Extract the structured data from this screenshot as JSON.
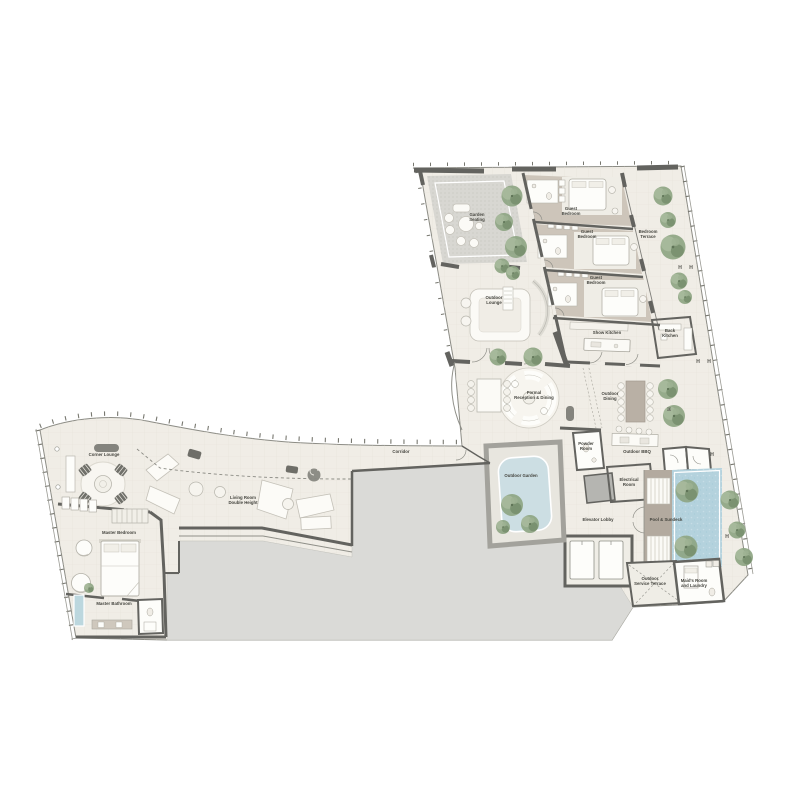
{
  "floorplan": {
    "type": "residential-floor-plan",
    "rooms": [
      {
        "id": "garden-seating",
        "label": "Garden Seating",
        "lines": [
          "Garden",
          "Seating"
        ],
        "x": 477,
        "y": 216
      },
      {
        "id": "guest-bedroom-1",
        "label": "Guest Bedroom",
        "lines": [
          "Guest",
          "Bedroom"
        ],
        "x": 571,
        "y": 210
      },
      {
        "id": "guest-bedroom-2",
        "label": "Guest Bedroom",
        "lines": [
          "Guest",
          "Bedroom"
        ],
        "x": 587,
        "y": 233
      },
      {
        "id": "guest-bedroom-3",
        "label": "Guest Bedroom",
        "lines": [
          "Guest",
          "Bedroom"
        ],
        "x": 596,
        "y": 279
      },
      {
        "id": "bedroom-terrace",
        "label": "Bedroom Terrace",
        "lines": [
          "Bedroom",
          "Terrace"
        ],
        "x": 648,
        "y": 233
      },
      {
        "id": "outdoor-lounge",
        "label": "Outdoor Lounge",
        "lines": [
          "Outdoor",
          "Lounge"
        ],
        "x": 494,
        "y": 299
      },
      {
        "id": "show-kitchen",
        "label": "Show Kitchen",
        "lines": [
          "Show Kitchen"
        ],
        "x": 607,
        "y": 334
      },
      {
        "id": "back-kitchen",
        "label": "Back Kitchen",
        "lines": [
          "Back",
          "Kitchen"
        ],
        "x": 670,
        "y": 332
      },
      {
        "id": "formal-reception-dining",
        "label": "Formal Reception & Dining",
        "lines": [
          "Formal",
          "Reception & Dining"
        ],
        "x": 534,
        "y": 394
      },
      {
        "id": "outdoor-dining",
        "label": "Outdoor Dining",
        "lines": [
          "Outdoor",
          "Dining"
        ],
        "x": 610,
        "y": 395
      },
      {
        "id": "powder-room",
        "label": "Powder Room",
        "lines": [
          "Powder",
          "Room"
        ],
        "x": 586,
        "y": 445
      },
      {
        "id": "outdoor-bbq",
        "label": "Outdoor BBQ",
        "lines": [
          "Outdoor BBQ"
        ],
        "x": 637,
        "y": 453
      },
      {
        "id": "outdoor-garden",
        "label": "Outdoor Garden",
        "lines": [
          "Outdoor Garden"
        ],
        "x": 521,
        "y": 477
      },
      {
        "id": "electrical-room",
        "label": "Electrical Room",
        "lines": [
          "Electrical",
          "Room"
        ],
        "x": 629,
        "y": 481
      },
      {
        "id": "elevator-lobby",
        "label": "Elevator Lobby",
        "lines": [
          "Elevator Lobby"
        ],
        "x": 598,
        "y": 521
      },
      {
        "id": "pool-sundeck",
        "label": "Pool & Sundeck",
        "lines": [
          "Pool & Sundeck"
        ],
        "x": 666,
        "y": 521
      },
      {
        "id": "outdoor-service-terrace",
        "label": "Outdoor Service Terrace",
        "lines": [
          "Outdoor",
          "Service Terrace"
        ],
        "x": 650,
        "y": 580
      },
      {
        "id": "maids-room-laundry",
        "label": "Maid's Room and Laundry",
        "lines": [
          "Maid's Room",
          "and Laundry"
        ],
        "x": 694,
        "y": 582
      },
      {
        "id": "corridor",
        "label": "Corridor",
        "lines": [
          "Corridor"
        ],
        "x": 401,
        "y": 453
      },
      {
        "id": "corner-lounge",
        "label": "Corner Lounge",
        "lines": [
          "Corner Lounge"
        ],
        "x": 104,
        "y": 456
      },
      {
        "id": "living-room",
        "label": "Living Room Double Height",
        "lines": [
          "Living Room",
          "Double Height"
        ],
        "x": 243,
        "y": 499
      },
      {
        "id": "master-bedroom",
        "label": "Master Bedroom",
        "lines": [
          "Master Bedroom"
        ],
        "x": 119,
        "y": 534
      },
      {
        "id": "master-bathroom",
        "label": "Master Bathroom",
        "lines": [
          "Master Bathroom"
        ],
        "x": 114,
        "y": 605
      }
    ],
    "markers": [
      {
        "char": "H",
        "x": 680,
        "y": 269
      },
      {
        "char": "H",
        "x": 691,
        "y": 269
      },
      {
        "char": "H",
        "x": 698,
        "y": 363
      },
      {
        "char": "H",
        "x": 709,
        "y": 363
      },
      {
        "char": "H",
        "x": 667,
        "y": 409,
        "rot": 90
      },
      {
        "char": "H",
        "x": 712,
        "y": 456
      },
      {
        "char": "H",
        "x": 727,
        "y": 538
      }
    ],
    "colors": {
      "floor": "#f0ede6",
      "void_gray": "#dadad7",
      "wall": "#63635f",
      "terrace_stipple": "#d8d7d2",
      "taupe_deck": "#b3aa9f",
      "pool_blue": "#b4d2dd",
      "pond_blue": "#ccdee3",
      "tree_green": "#8ea583",
      "label_text": "#44443e"
    }
  }
}
